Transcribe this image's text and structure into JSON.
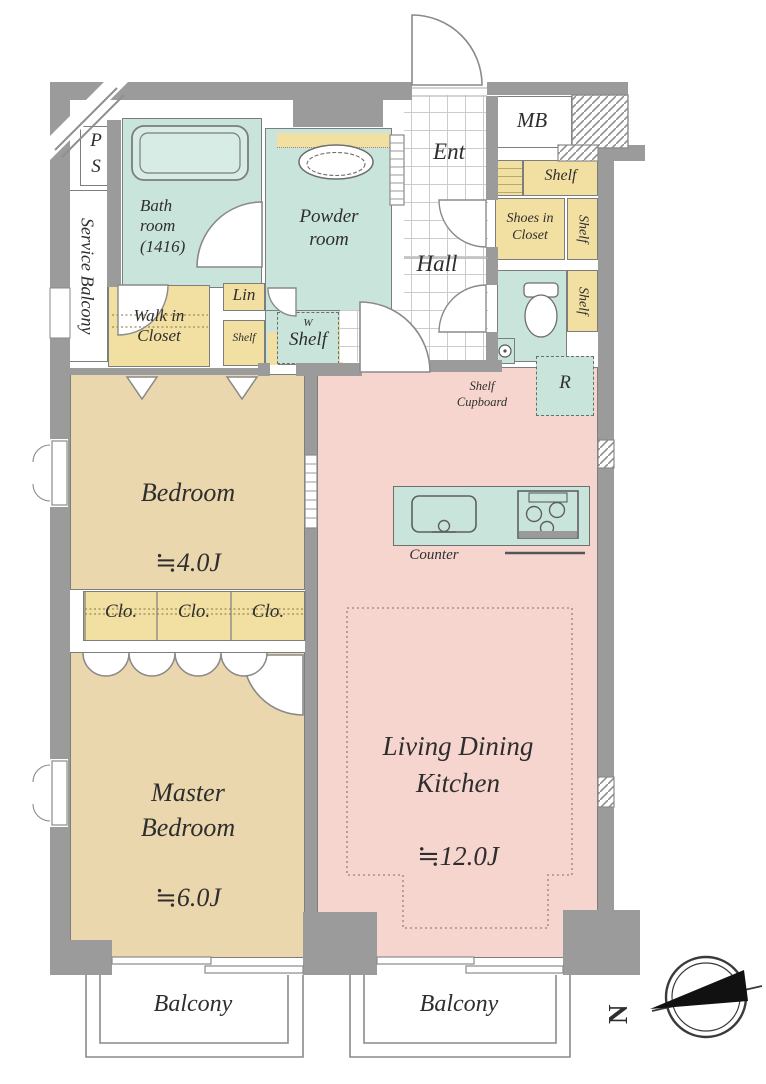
{
  "plan": {
    "labels": {
      "ps": "P\nS",
      "service_balcony": "Service Balcony",
      "bath": "Bath\nroom\n(1416)",
      "powder": "Powder\nroom",
      "ent": "Ent",
      "hall": "Hall",
      "mb": "MB",
      "shelf_top": "Shelf",
      "shoes_closet": "Shoes in\nCloset",
      "shelf_side_upper": "Shelf",
      "shelf_side_lower": "Shelf",
      "lin": "Lin",
      "walk_in_closet": "Walk in\nCloset",
      "shelf_small": "Shelf",
      "washer": "W",
      "w_shelf": "Shelf",
      "shelf_cupboard": "Shelf\nCupboard",
      "refrigerator": "R",
      "bedroom": "Bedroom",
      "bedroom_size": "≒4.0J",
      "closet_1": "Clo.",
      "closet_2": "Clo.",
      "closet_3": "Clo.",
      "master_bedroom": "Master\nBedroom",
      "master_size": "≒6.0J",
      "ldk": "Living Dining\nKitchen",
      "ldk_size": "≒12.0J",
      "counter": "Counter",
      "balcony_left": "Balcony",
      "balcony_right": "Balcony",
      "compass_north": "N"
    },
    "colors": {
      "wall": "#9b9b9b",
      "wet_area": "#c9e5db",
      "storage": "#f2dfa2",
      "bedroom": "#ead7ae",
      "ldk": "#f7d5cf",
      "outline": "#7d7d7d"
    }
  }
}
